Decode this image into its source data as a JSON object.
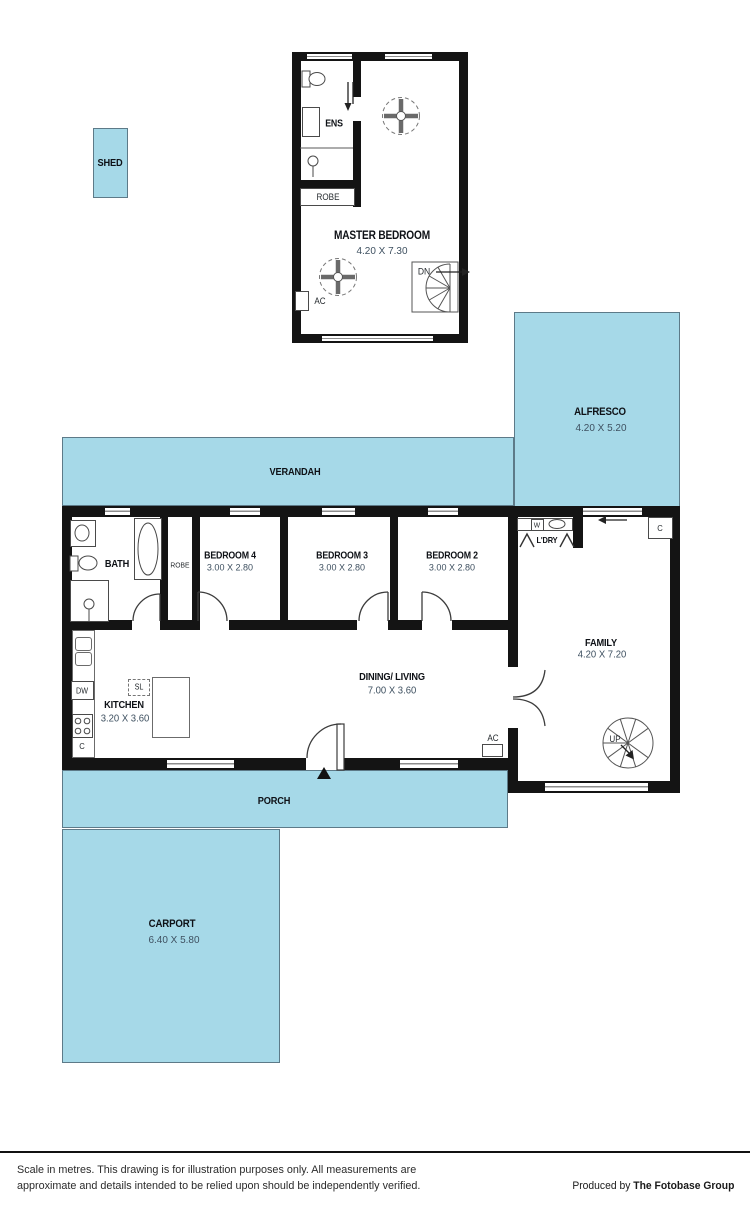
{
  "colors": {
    "area_fill": "#a6d9e8",
    "wall": "#141414",
    "dim_text": "#3e5060"
  },
  "upper_level": {
    "ens": "ENS",
    "robe": "ROBE",
    "master_label": "MASTER BEDROOM",
    "master_dim": "4.20 X 7.30",
    "ac": "AC",
    "down": "DN"
  },
  "outdoor": {
    "shed": "SHED",
    "alfresco_label": "ALFRESCO",
    "alfresco_dim": "4.20 X 5.20",
    "verandah": "VERANDAH",
    "porch": "PORCH",
    "carport_label": "CARPORT",
    "carport_dim": "6.40 X 5.80"
  },
  "ground": {
    "bath": "BATH",
    "robe": "ROBE",
    "bed4_label": "BEDROOM 4",
    "bed4_dim": "3.00 X 2.80",
    "bed3_label": "BEDROOM 3",
    "bed3_dim": "3.00 X 2.80",
    "bed2_label": "BEDROOM 2",
    "bed2_dim": "3.00 X 2.80",
    "laundry": "L'DRY",
    "washer": "W",
    "cupboard": "C",
    "family_label": "FAMILY",
    "family_dim": "4.20 X 7.20",
    "kitchen_label": "KITCHEN",
    "kitchen_dim": "3.20 X 3.60",
    "dining_label": "DINING/ LIVING",
    "dining_dim": "7.00 X 3.60",
    "dishwasher": "DW",
    "skylight": "SL",
    "ac": "AC",
    "up": "UP"
  },
  "footer": {
    "disclaimer_line1": "Scale in metres. This drawing is for illustration purposes only. All measurements are",
    "disclaimer_line2": "approximate and details intended to be relied upon should be independently verified.",
    "produced_by": "Produced by",
    "company": "The Fotobase Group"
  }
}
